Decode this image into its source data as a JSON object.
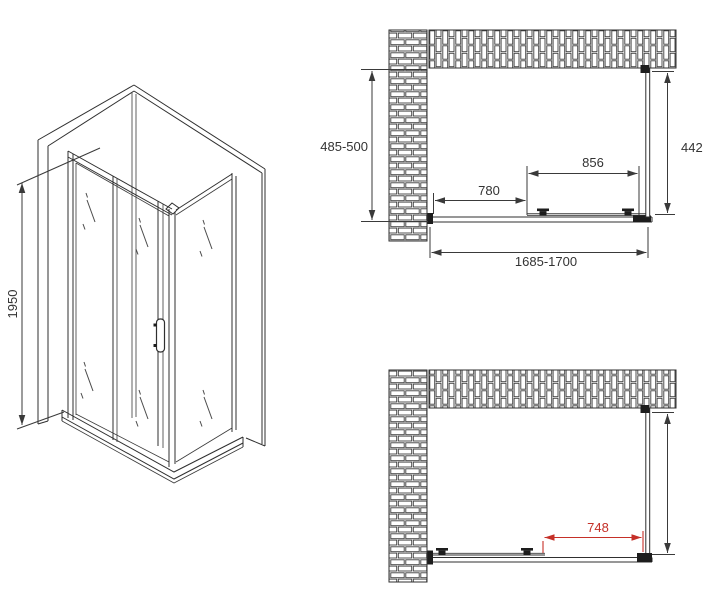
{
  "colors": {
    "line": "#2f2f2f",
    "dimension": "#333333",
    "dimension_red": "#c53028",
    "background": "#ffffff"
  },
  "isometric_view": {
    "height": "1950"
  },
  "plan_top": {
    "depth": "485-500",
    "panel_width": "442",
    "door_width": "856",
    "entry_width": "780",
    "total_width": "1685-1700"
  },
  "plan_bottom": {
    "open_width": "748"
  }
}
